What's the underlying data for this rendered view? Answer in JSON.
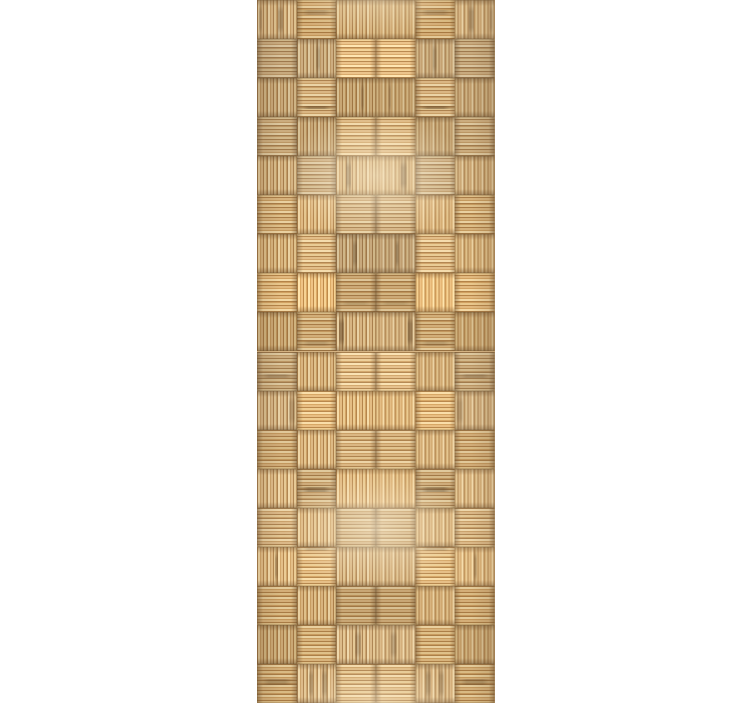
{
  "page": {
    "background_color": "#ffffff"
  },
  "image": {
    "name": "bamboo-basketweave-texture",
    "alt": "Tall vertical panel of woven bamboo basket-weave texture with mirrored symmetric pattern on a white background",
    "palette": {
      "strip_light": "#e7d0a4",
      "strip_light2": "#dcc08e",
      "strip_mid": "#d5b382",
      "strip_base": "#c49c66",
      "strip_dark": "#a87f4e",
      "seam": "#6e5233",
      "streak": "#553e24",
      "glow": "#fff3d9"
    },
    "pattern": {
      "type": "basket-weave",
      "grid_cols": 6,
      "grid_rows": 18,
      "mirror_horizontal": true,
      "vertical_period_rows": 9
    }
  }
}
